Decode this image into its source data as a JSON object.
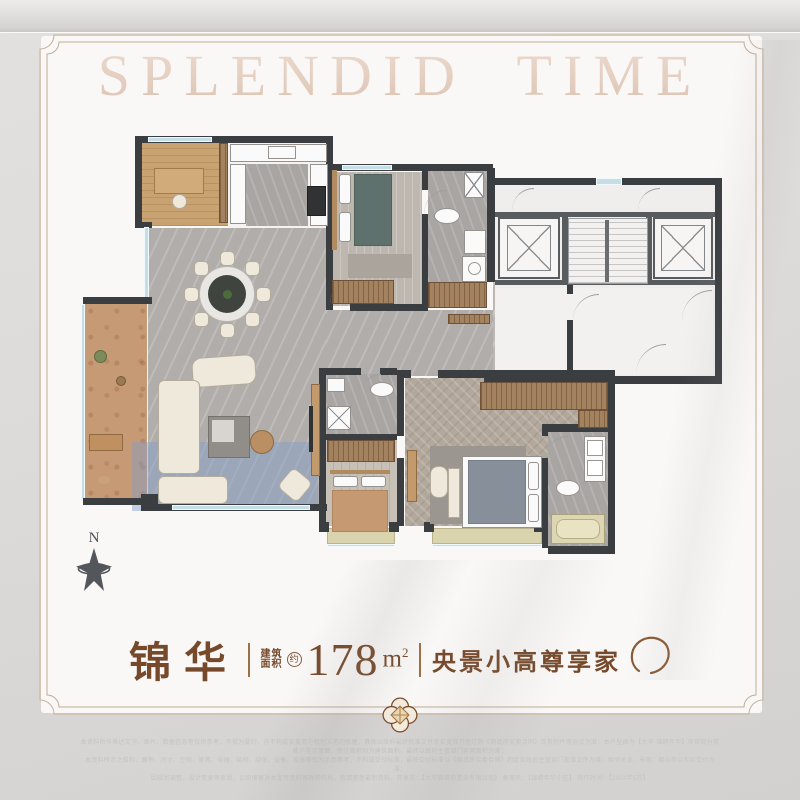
{
  "watermark": {
    "text": "SPLENDID TIME"
  },
  "compass": {
    "north_label": "N"
  },
  "title": {
    "name": "锦华",
    "area_label_top": "建筑",
    "area_label_bottom": "面积",
    "area_approx": "约",
    "area_value": "178",
    "area_unit": "m",
    "area_exponent": "2",
    "tagline": "央景小高尊享家"
  },
  "disclaimer": {
    "line1": "本资料所作表达文字、图片、数据信息等仅供参考，不视为要约，亦不构成买卖双方权利义务的依据，具体以政府最终批准文件及买卖双方签订的《商品房买卖合同》及其附件等协议为准；本户型图为【大华·锦绣年华】项目部分楼栋户型示意图，所注面积均为建筑面积，最终以政府主管部门实测面积为准；",
    "line2": "本资料所示之结构、面积、尺寸、空间、家具、电器、装修、绿化、设备、设施等仅为示意参考，不构成交付标准，最终交付标准以《商品房买卖合同》约定及政府主管部门批准文件为准；相邻关系、景观、朝向等以实际交付为准；",
    "line3": "因规划调整、设计变更等原因，公司保留对本宣传资料修改的权利，敬请留意最新资料。开发商：【大华锦绣府置业有限公司】  备案名：【锦绣年华小区】  制作时间：【2024年5月】"
  },
  "colors": {
    "accent_brown": "#7a4b2d",
    "frame_gold": "#c9b299",
    "wall_dark": "#3b3e41",
    "highlight_blue": "#7f9ecb",
    "balcony_terracotta": "#c79a76"
  }
}
